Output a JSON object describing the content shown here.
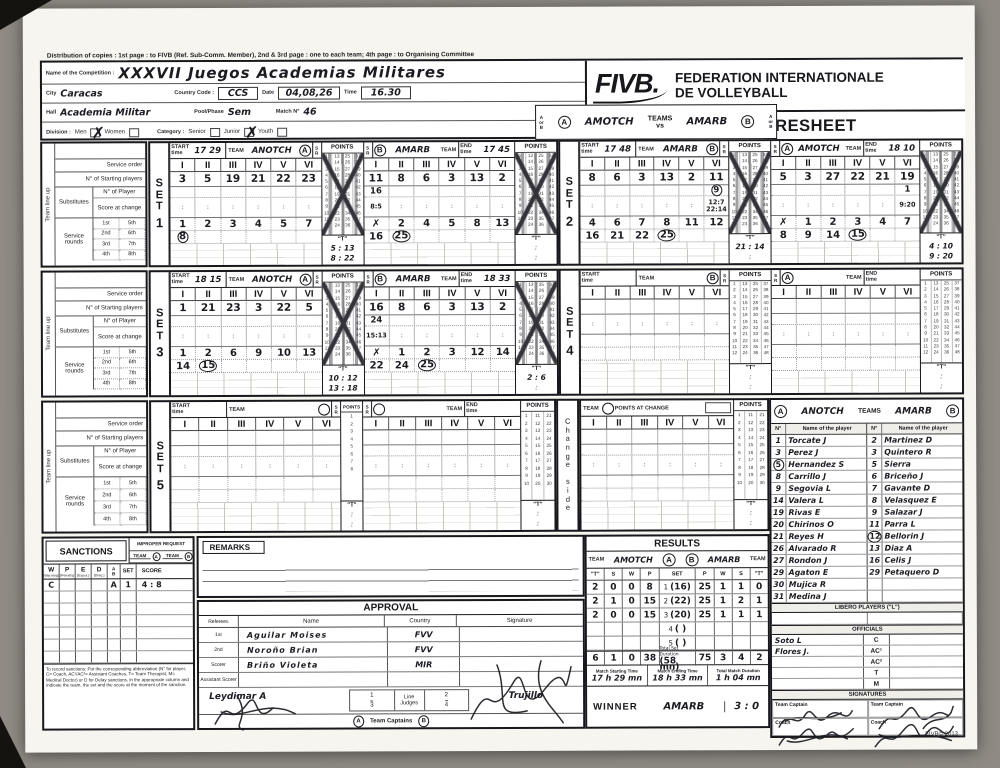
{
  "page": {
    "distribution": "Distribution of copies : 1st page : to FIVB (Ref. Sub-Comm. Member), 2nd & 3rd page : one to each team; 4th page : to Organising Committee",
    "copyright": "FIVB© 2013"
  },
  "header": {
    "competition_label": "Name of the Competition :",
    "competition": "XXXVII Juegos Academias Militares",
    "city_label": "City",
    "city": "Caracas",
    "country_code_label": "Country Code :",
    "country_code": "CCS",
    "date_label": "Date",
    "date": "04,08,26",
    "time_label": "Time",
    "time": "16.30",
    "hall_label": "Hall",
    "hall": "Academia Militar",
    "phase_label": "Pool/Phase",
    "phase": "Sem",
    "match_label": "Match N°",
    "match_no": "46",
    "division_label": "Division :",
    "men": "Men",
    "men_mark": "✗",
    "women": "Women",
    "women_mark": "",
    "category_label": "Category :",
    "senior": "Senior",
    "senior_mark": "",
    "junior": "Junior",
    "junior_mark": "✗",
    "youth": "Youth",
    "youth_mark": "",
    "a": "A",
    "b": "B",
    "or_word": "or",
    "team_a": "AMOTCH",
    "team_b": "AMARB",
    "teams_label": "TEAMS",
    "vs": "vs",
    "fivb": "FIVB.",
    "federation1": "FEDERATION INTERNATIONALE",
    "federation2": "DE VOLLEYBALL",
    "title": "INTERNATIONAL SCORESHEET"
  },
  "labels": {
    "team_line_up": "Team line up",
    "service_order": "Service order",
    "starting_players": "N° of Starting players",
    "substitutes": "Substitutes",
    "n_of_player": "N° of Player",
    "score_at_change": "Score at change",
    "service_rounds": "Service rounds",
    "ordinals": [
      "1st",
      "2nd",
      "3rd",
      "4th",
      "5th",
      "6th",
      "7th",
      "8th"
    ],
    "start_time": "START\ntime",
    "end_time": "END\ntime",
    "team": "TEAM",
    "points": "POINTS",
    "s": "S",
    "r": "R",
    "t": "\"T\"",
    "romans": [
      "I",
      "II",
      "III",
      "IV",
      "V",
      "VI"
    ],
    "set_letters": "S\nE\nT",
    "change_side": "C\nh\na\nn\ng\ne\n\ns\ni\nd\ne",
    "points_at_change": "POINTS AT CHANGE",
    "p12": "1\n2\n3\n4\n5\n6\n7\n8\n9\n10\n11\n12",
    "p24": "13\n14\n15\n16\n17\n18\n19\n20\n21\n22\n23\n24",
    "p36": "25\n26\n27\n28\n29\n30\n31\n32\n33\n34\n35\n36",
    "p48": "37\n38\n39\n40\n41\n42\n43\n44\n45\n46\n47\n48",
    "p8": "1\n2\n3\n4\n5\n6\n7\n8",
    "p10": "1\n2\n3\n4\n5\n6\n7\n8\n9\n10",
    "p20": "11\n12\n13\n14\n15\n16\n17\n18\n19\n20",
    "p30": "21\n22\n23\n24\n25\n26\n27\n28\n29\n30"
  },
  "sets": [
    {
      "num": "1",
      "left": {
        "pos": "A",
        "start": "17 29",
        "team": "ANOTCH",
        "starters": [
          "3",
          "5",
          "19",
          "21",
          "22",
          "23"
        ],
        "subs": [
          "",
          "",
          "",
          "",
          "",
          ""
        ],
        "chg": [
          "",
          "",
          "",
          "",
          "",
          ""
        ],
        "r1": [
          "1",
          "2",
          "3",
          "4",
          "5",
          "7"
        ],
        "r2": [
          "8",
          "",
          "",
          "",
          "",
          ""
        ],
        "t1": "5 : 13",
        "t2": "8 : 22"
      },
      "right": {
        "pos": "B",
        "end": "17 45",
        "team": "AMARB",
        "starters": [
          "11",
          "8",
          "6",
          "3",
          "13",
          "2"
        ],
        "subs": [
          "16",
          "",
          "",
          "",
          "",
          ""
        ],
        "chg": [
          "8:5",
          "",
          "",
          "",
          "",
          ""
        ],
        "r1": [
          "✗",
          "2",
          "4",
          "5",
          "8",
          "13"
        ],
        "r2": [
          "16",
          "25",
          "",
          "",
          "",
          ""
        ],
        "t1": "",
        "t2": ""
      }
    },
    {
      "num": "2",
      "left": {
        "pos": "B",
        "start": "17 48",
        "team": "AMARB",
        "starters": [
          "8",
          "6",
          "3",
          "13",
          "2",
          "11"
        ],
        "subs": [
          "",
          "",
          "",
          "",
          "",
          "9"
        ],
        "chg": [
          "",
          "",
          "",
          "",
          "",
          "12:7\n22:14"
        ],
        "r1": [
          "4",
          "6",
          "7",
          "8",
          "11",
          "12"
        ],
        "r2": [
          "16",
          "21",
          "22",
          "25",
          "",
          ""
        ],
        "t1": "21 : 14",
        "t2": ""
      },
      "right": {
        "pos": "A",
        "end": "18 10",
        "team": "AMOTCH",
        "starters": [
          "5",
          "3",
          "27",
          "22",
          "21",
          "19"
        ],
        "subs": [
          "",
          "",
          "",
          "",
          "",
          "1"
        ],
        "chg": [
          "",
          "",
          "",
          "",
          "",
          "9:20"
        ],
        "r1": [
          "✗",
          "1",
          "2",
          "3",
          "4",
          "7"
        ],
        "r2": [
          "8",
          "9",
          "14",
          "15",
          "",
          ""
        ],
        "t1": "4 : 10",
        "t2": "9 : 20"
      }
    },
    {
      "num": "3",
      "left": {
        "pos": "A",
        "start": "18 15",
        "team": "ANOTCH",
        "starters": [
          "1",
          "21",
          "23",
          "3",
          "22",
          "5"
        ],
        "subs": [
          "",
          "",
          "",
          "",
          "",
          ""
        ],
        "chg": [
          "",
          "",
          "",
          "",
          "",
          ""
        ],
        "r1": [
          "1",
          "2",
          "6",
          "9",
          "10",
          "13"
        ],
        "r2": [
          "14",
          "15",
          "",
          "",
          "",
          ""
        ],
        "t1": "10 : 12",
        "t2": "13 : 18"
      },
      "right": {
        "pos": "B",
        "end": "18 33",
        "team": "AMARB",
        "starters": [
          "16",
          "8",
          "6",
          "3",
          "13",
          "2"
        ],
        "subs": [
          "24",
          "",
          "",
          "",
          "",
          ""
        ],
        "chg": [
          "15:13",
          "",
          "",
          "",
          "",
          ""
        ],
        "r1": [
          "✗",
          "1",
          "2",
          "3",
          "12",
          "14"
        ],
        "r2": [
          "22",
          "24",
          "25",
          "",
          "",
          ""
        ],
        "t1": "2 : 6",
        "t2": ""
      }
    },
    {
      "num": "4",
      "left": {
        "pos": "B",
        "start": "",
        "team": "",
        "starters": [
          "",
          "",
          "",
          "",
          "",
          ""
        ],
        "subs": [],
        "chg": [],
        "r1": [],
        "r2": [],
        "t1": "",
        "t2": ""
      },
      "right": {
        "pos": "A",
        "end": "",
        "team": "",
        "starters": [],
        "subs": [],
        "chg": [],
        "r1": [],
        "r2": [],
        "t1": "",
        "t2": ""
      }
    },
    {
      "num": "5",
      "left": {
        "pos": "",
        "start": "",
        "team": "",
        "starters": [],
        "subs": [],
        "chg": [],
        "r1": [],
        "r2": [],
        "t1": "",
        "t2": ""
      },
      "right": {
        "pos": "",
        "end": "",
        "team": "",
        "starters": [],
        "subs": [],
        "chg": [],
        "r1": [],
        "r2": [],
        "t1": "",
        "t2": ""
      }
    }
  ],
  "roster": {
    "a_letter": "A",
    "b_letter": "B",
    "teams_label": "TEAMS",
    "team_a": "ANOTCH",
    "team_b": "AMARB",
    "col_no": "N°",
    "col_name": "Name of the player",
    "a": [
      [
        "1",
        "Torcate J"
      ],
      [
        "3",
        "Perez J"
      ],
      [
        "5",
        "Hernandez S"
      ],
      [
        "8",
        "Carrillo J"
      ],
      [
        "9",
        "Segovia L"
      ],
      [
        "14",
        "Valera L"
      ],
      [
        "19",
        "Rivas E"
      ],
      [
        "20",
        "Chirinos O"
      ],
      [
        "21",
        "Reyes H"
      ],
      [
        "26",
        "Alvarado R"
      ],
      [
        "27",
        "Rondon J"
      ],
      [
        "29",
        "Agaton E"
      ],
      [
        "30",
        "Mujica R"
      ],
      [
        "31",
        "Medina J"
      ]
    ],
    "b": [
      [
        "2",
        "Martinez D"
      ],
      [
        "3",
        "Quintero R"
      ],
      [
        "5",
        "Sierra"
      ],
      [
        "6",
        "Briceño J"
      ],
      [
        "7",
        "Gavante D"
      ],
      [
        "8",
        "Velasquez E"
      ],
      [
        "9",
        "Salazar J"
      ],
      [
        "11",
        "Parra L"
      ],
      [
        "12",
        "Bellorin J"
      ],
      [
        "13",
        "Diaz A"
      ],
      [
        "16",
        "Celis J"
      ],
      [
        "29",
        "Petaquero D"
      ]
    ],
    "libero_title": "LIBERO PLAYERS (\"L\")",
    "officials_title": "OFFICIALS",
    "officials": [
      {
        "name": "Soto L",
        "role": "C"
      },
      {
        "name": "Flores J.",
        "role": "AC¹"
      },
      {
        "name": "",
        "role": "AC²"
      },
      {
        "name": "",
        "role": "T"
      },
      {
        "name": "",
        "role": "M"
      }
    ],
    "signatures_title": "SIGNATURES",
    "sig_captain": "Team Captain",
    "sig_coach": "Coach"
  },
  "results": {
    "title": "RESULTS",
    "team_label": "TEAM",
    "team_a": "AMOTCH",
    "team_b": "AMARB",
    "a": "A",
    "b": "B",
    "cols": [
      "\"T\"",
      "S",
      "W",
      "P",
      "SET",
      "P",
      "W",
      "S",
      "\"T\""
    ],
    "rows": [
      {
        "a": [
          "2",
          "0",
          "0",
          "8"
        ],
        "set": "1",
        "dur": "(16)",
        "b": [
          "25",
          "1",
          "1",
          "0"
        ]
      },
      {
        "a": [
          "2",
          "1",
          "0",
          "15"
        ],
        "set": "2",
        "dur": "(22)",
        "b": [
          "25",
          "1",
          "2",
          "1"
        ]
      },
      {
        "a": [
          "2",
          "0",
          "0",
          "15"
        ],
        "set": "3",
        "dur": "(20)",
        "b": [
          "25",
          "1",
          "1",
          "1"
        ]
      },
      {
        "a": [
          "",
          "",
          "",
          ""
        ],
        "set": "4",
        "dur": "(    )",
        "b": [
          "",
          "",
          "",
          ""
        ]
      },
      {
        "a": [
          "",
          "",
          "",
          ""
        ],
        "set": "5",
        "dur": "(    )",
        "b": [
          "",
          "",
          "",
          ""
        ]
      }
    ],
    "total_a": [
      "6",
      "1",
      "0",
      "38"
    ],
    "total_label": "Total Set Duration",
    "total_dur": "(58 mn)",
    "total_b": [
      "75",
      "3",
      "4",
      "2"
    ],
    "start_label": "Match Starting Time",
    "start_val": "17 h 29 mn",
    "end_label": "Match Ending Time",
    "end_val": "18 h 33 mn",
    "dur_label": "Total Match Duration",
    "dur_val": "1 h 04 mn",
    "winner_label": "WINNER",
    "winner_val": "AMARB",
    "winner_score": "3 : 0"
  },
  "sanctions": {
    "title": "SANCTIONS",
    "improper": "IMPROPER REQUEST",
    "team_word": "TEAM",
    "a": "A",
    "b": "B",
    "cols": [
      "W",
      "P",
      "E",
      "D"
    ],
    "subs": [
      "(Warning)",
      "(Penalty)",
      "(Expul.)",
      "(Disq.)"
    ],
    "col_ab": "A\nB",
    "col_set": "SET",
    "col_score": "SCORE",
    "row": {
      "w": "C",
      "p": "",
      "e": "",
      "d": "",
      "ab": "A",
      "set": "1",
      "score": "4 : 8"
    },
    "note": "To record sanctions: Put the corresponding abbreviation (N° for player, C= Coach, AC¹/AC²= Assistant Coaches, T= Team Therapist, M= Medical Doctor) or D for Delay sanctions, in the appropriate column and indicate the team, the set and the score at the moment of the sanction."
  },
  "remarks": {
    "title": "REMARKS"
  },
  "approval": {
    "title": "APPROVAL",
    "col_ref": "Referees",
    "col_name": "Name",
    "col_country": "Country",
    "col_sig": "Signature",
    "rows": [
      {
        "role": "1st",
        "name": "Aguilar Moises",
        "country": "FVV"
      },
      {
        "role": "2nd",
        "name": "Noroño Brian",
        "country": "FVV"
      },
      {
        "role": "Scorer",
        "name": "Briño Violeta",
        "country": "MIR"
      },
      {
        "role": "Assistant Scorer",
        "name": "",
        "country": ""
      }
    ],
    "scorer_hand": "Leydimar A",
    "line_judges": "Line Judges",
    "lj1": "1",
    "lj2": "2",
    "lj3": "3",
    "lj4": "4",
    "lj_hand": "Trujillo",
    "captains": "Team Captains",
    "cap_a": "A",
    "cap_b": "B"
  }
}
